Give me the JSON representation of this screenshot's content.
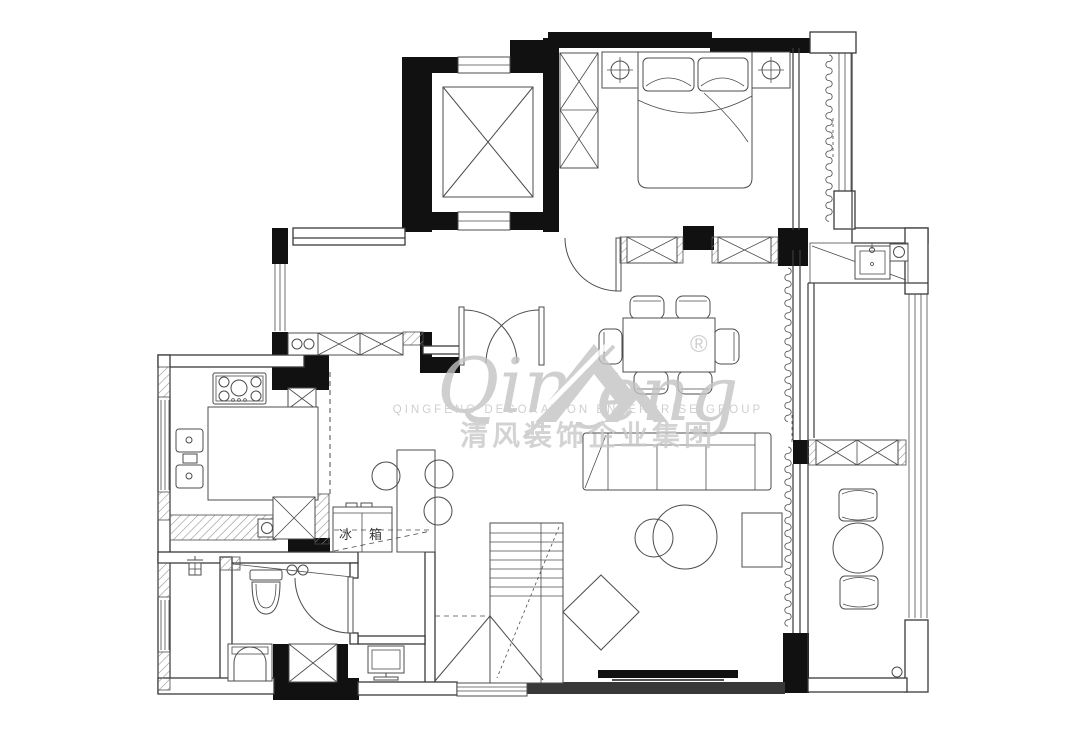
{
  "watermark": {
    "script_left": "Qing",
    "script_right": "eng",
    "registered_mark": "®",
    "subtitle_en": "QINGFENG  DECORATION  ENTERPRISE  GROUP",
    "title_cn": "清风装饰企业集团"
  },
  "labels": {
    "fridge": "冰箱"
  },
  "colors": {
    "wall": "#111111",
    "ln": "#3a3a3a",
    "ln2": "#4c4c4c",
    "wm": "#c2c2c2",
    "wm2": "#c7c7c7",
    "bg": "#ffffff"
  },
  "icons": {
    "elevator": "elevator-shaft-icon",
    "stairs": "staircase-icon",
    "bed": "double-bed-icon",
    "lamp": "ceiling-lamp-icon",
    "wardrobe": "wardrobe-icon",
    "stove": "gas-stove-icon",
    "sink": "kitchen-sink-icon",
    "fridge": "refrigerator-icon",
    "toilet": "toilet-icon",
    "washer": "washing-machine-icon",
    "sofa": "sofa-icon",
    "tv": "tv-icon",
    "curtain": "curtain-icon",
    "drain": "floor-drain-icon"
  }
}
